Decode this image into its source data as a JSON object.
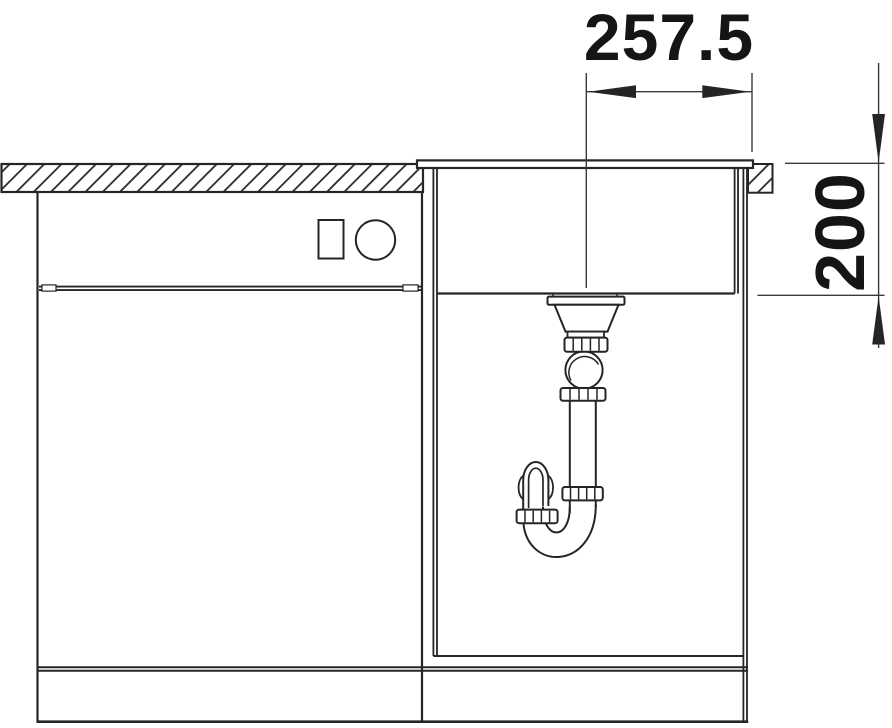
{
  "diagram": {
    "type": "technical-drawing",
    "subject": "Kitchen sink front elevation: countertop cross-section, base cabinets, inset sink bowl with strainer and siphon trap",
    "dimensions": {
      "width_label": "257.5",
      "depth_label": "200"
    },
    "colors": {
      "line": "#252525",
      "dim_line": "#3a3a3a",
      "hatch": "#2b2b2b",
      "background": "#ffffff",
      "text": "#151515"
    }
  }
}
